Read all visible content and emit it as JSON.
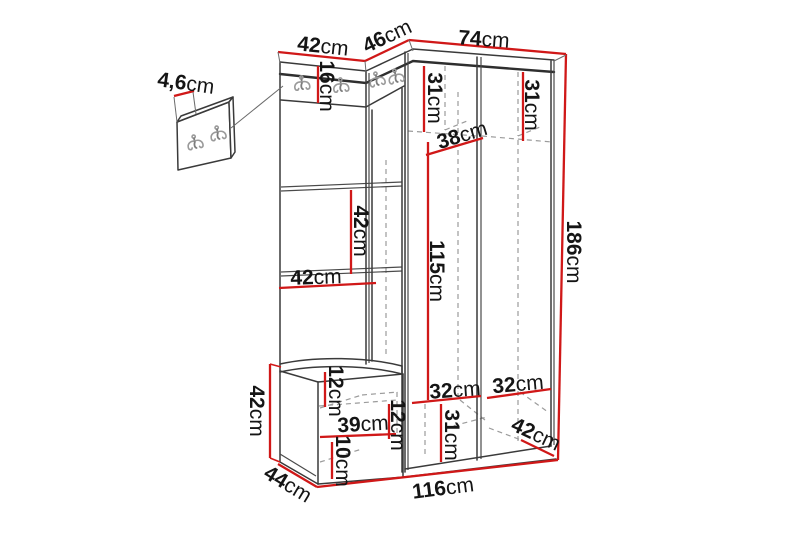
{
  "diagram": {
    "description": "Dimension drawing of a corner hallway furniture set: wall hook panel, upholstered panel wall with bench and corner wardrobe",
    "unit_suffix": "cm",
    "hook_icon": "double-prong-wall-hook",
    "colors": {
      "dimension_line": "#d01818",
      "outline": "#3a3a3a",
      "dashed_interior": "#9b9b9b",
      "text": "#151515",
      "background": "#ffffff"
    }
  },
  "dims": {
    "hook_panel_thickness": {
      "value": "4,6",
      "unit": "cm"
    },
    "top_width_left": {
      "value": "42",
      "unit": "cm"
    },
    "top_width_corner": {
      "value": "46",
      "unit": "cm"
    },
    "top_width_right": {
      "value": "74",
      "unit": "cm"
    },
    "hook_rail_height": {
      "value": "16",
      "unit": "cm"
    },
    "upper_compartment_left_height": {
      "value": "31",
      "unit": "cm"
    },
    "upper_compartment_right_height": {
      "value": "31",
      "unit": "cm"
    },
    "upper_shelf_depth": {
      "value": "38",
      "unit": "cm"
    },
    "panel_square_height": {
      "value": "42",
      "unit": "cm"
    },
    "panel_width": {
      "value": "42",
      "unit": "cm"
    },
    "hanging_section_height": {
      "value": "115",
      "unit": "cm"
    },
    "total_height": {
      "value": "186",
      "unit": "cm"
    },
    "lower_shelf_left_width": {
      "value": "32",
      "unit": "cm"
    },
    "lower_shelf_right_width": {
      "value": "32",
      "unit": "cm"
    },
    "lower_compartment_height": {
      "value": "31",
      "unit": "cm"
    },
    "wardrobe_depth": {
      "value": "42",
      "unit": "cm"
    },
    "bench_height": {
      "value": "42",
      "unit": "cm"
    },
    "seat_thickness": {
      "value": "12",
      "unit": "cm"
    },
    "bench_inner_width": {
      "value": "39",
      "unit": "cm"
    },
    "bench_inner_height": {
      "value": "12",
      "unit": "cm"
    },
    "bench_base_height": {
      "value": "10",
      "unit": "cm"
    },
    "bench_depth": {
      "value": "44",
      "unit": "cm"
    },
    "total_width": {
      "value": "116",
      "unit": "cm"
    }
  }
}
